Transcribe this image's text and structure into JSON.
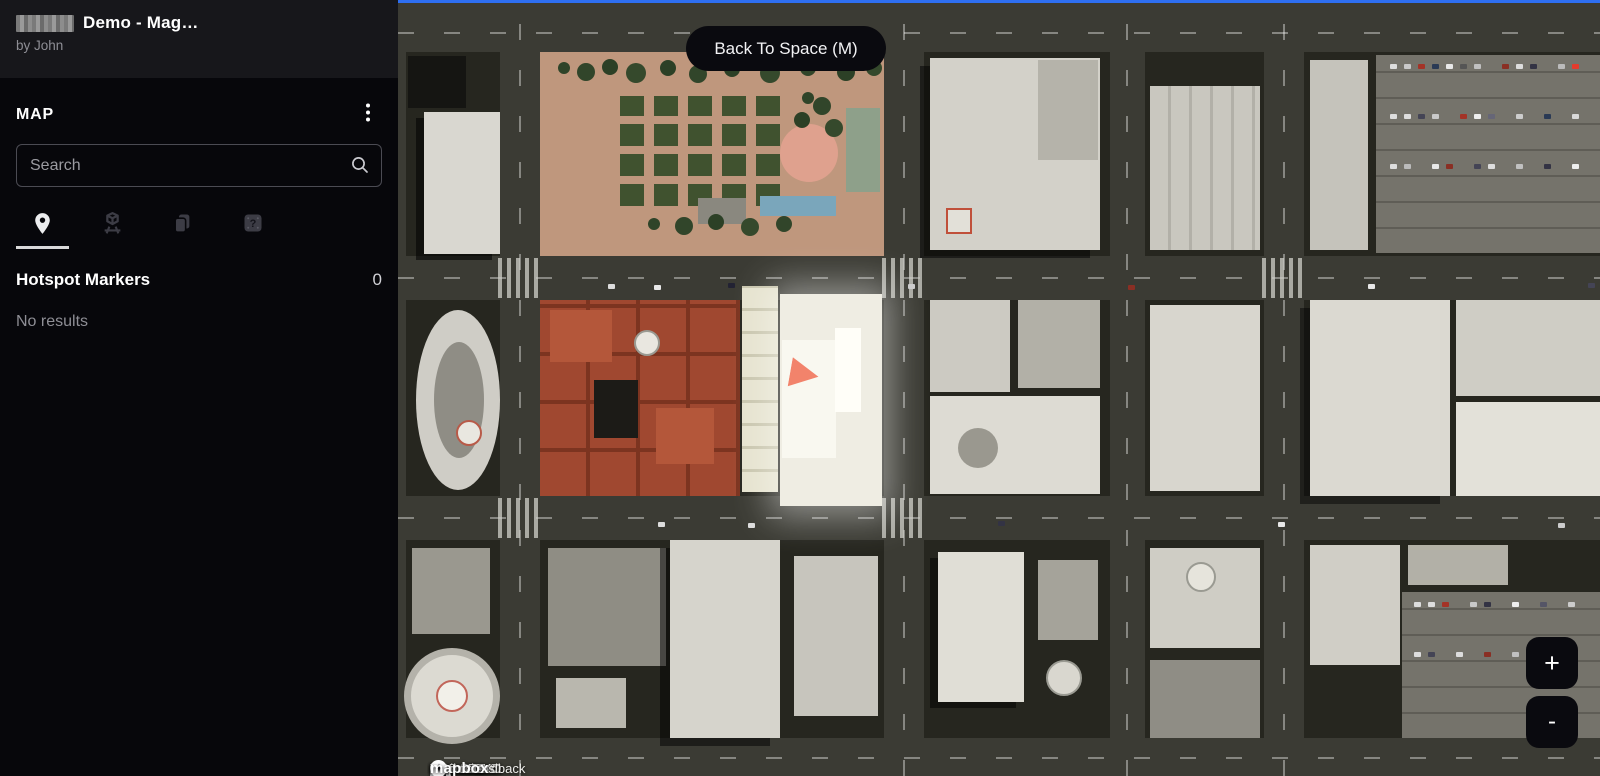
{
  "sidebar": {
    "title": "Demo - Mag…",
    "byline": "by John",
    "section_label": "MAP",
    "menu_icon": "kebab-menu-icon",
    "search": {
      "placeholder": "Search"
    },
    "tabs": [
      {
        "name": "hotspot-markers",
        "icon": "map-pin-icon",
        "active": true
      },
      {
        "name": "3d-models",
        "icon": "cube-projection-icon",
        "active": false
      },
      {
        "name": "copies",
        "icon": "pages-icon",
        "active": false
      },
      {
        "name": "help",
        "icon": "help-square-icon",
        "active": false
      }
    ],
    "list": {
      "header": "Hotspot Markers",
      "count": "0",
      "empty_text": "No results"
    }
  },
  "map": {
    "back_button_label": "Back To Space (M)",
    "zoom_in_label": "+",
    "zoom_out_label": "-",
    "marker_color": "#f2836b",
    "boundary_color": "#2e6ff2",
    "attribution": {
      "client_version": "Client 2.24.1",
      "gsp_version": "GSP 4.19.0",
      "tenant": "Tenant OKO",
      "share_feedback": "Share Feedback",
      "attributions": "Attributions",
      "map_data_label": "Map data:",
      "provider": "mapbox"
    }
  }
}
